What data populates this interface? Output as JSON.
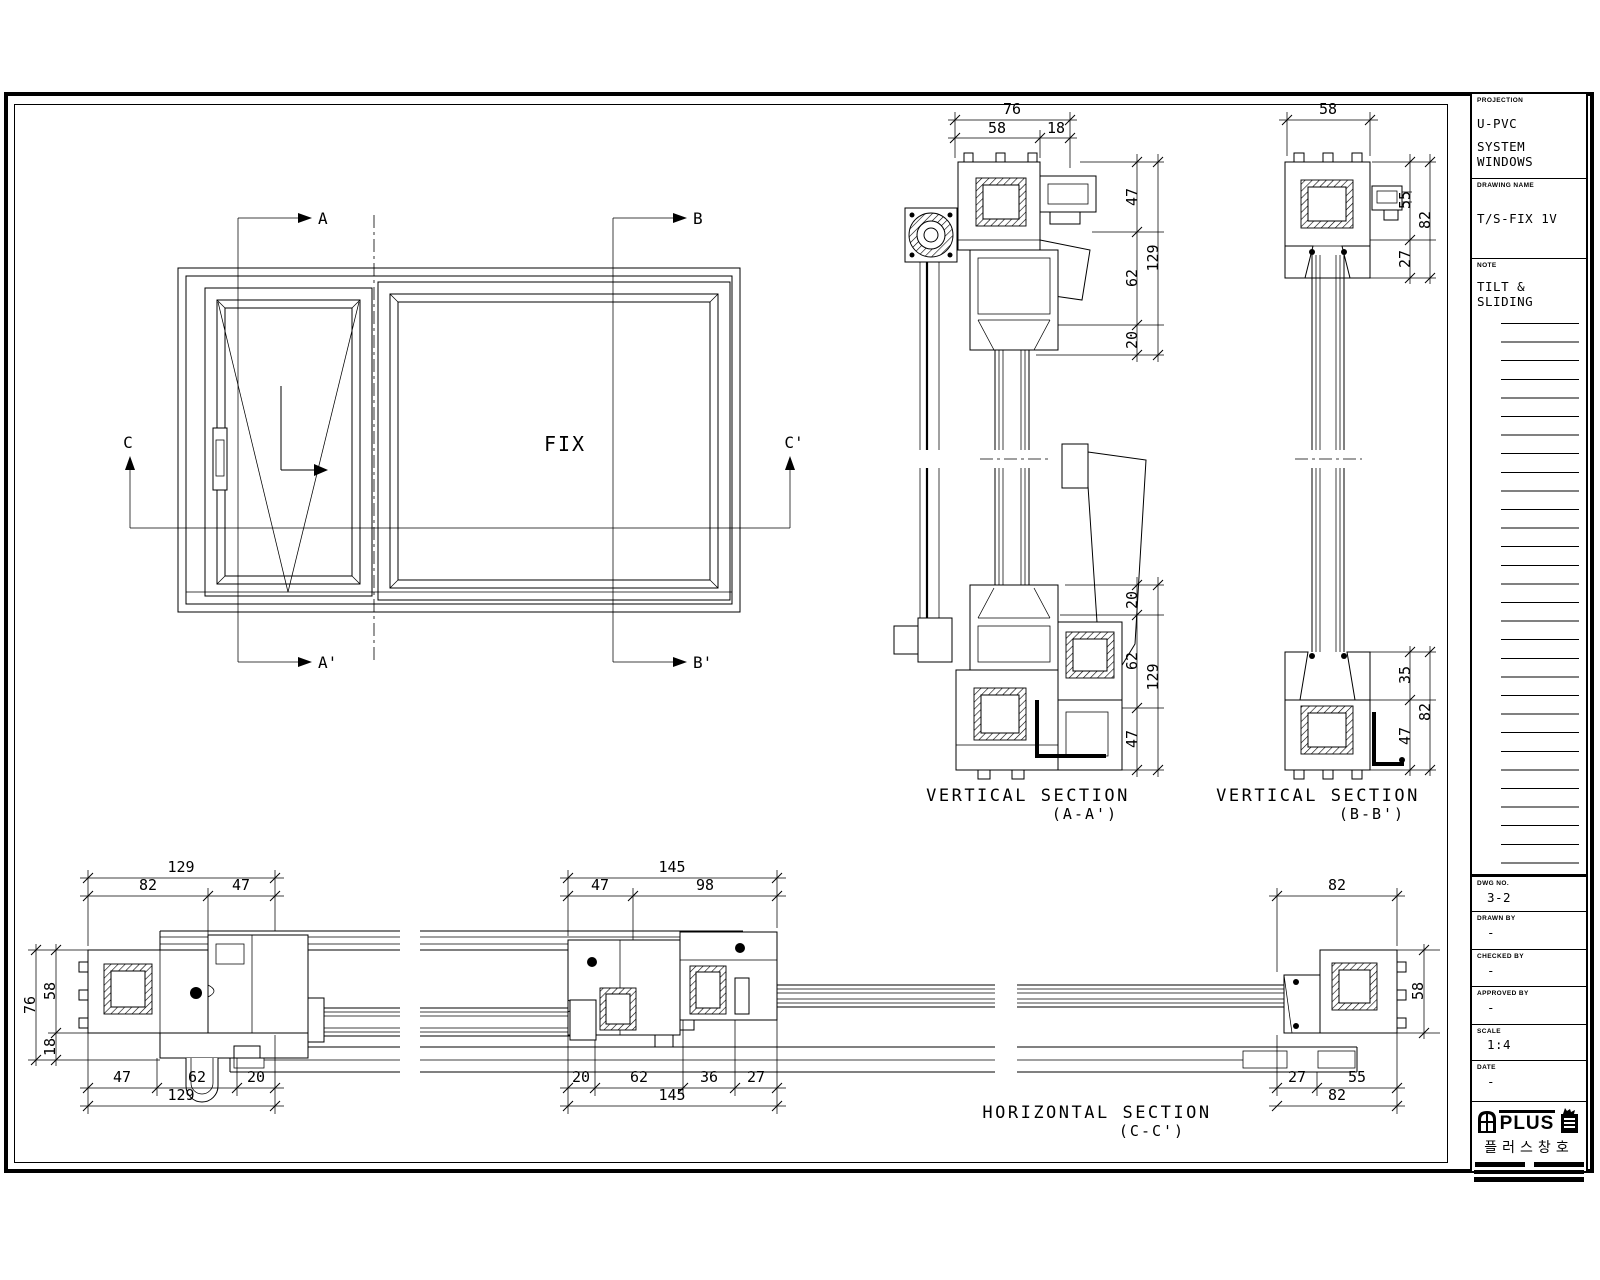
{
  "elevation": {
    "fix_label": "FIX",
    "marker_a": "A",
    "marker_a_prime": "A'",
    "marker_b": "B",
    "marker_b_prime": "B'",
    "marker_c": "C",
    "marker_c_prime": "C'"
  },
  "sections": {
    "aa": {
      "title": "VERTICAL SECTION",
      "subtitle": "(A-A')",
      "top_total": "76",
      "top_a": "58",
      "top_b": "18",
      "rt_a": "47",
      "rt_b": "62",
      "rt_c": "20",
      "rt_total": "129",
      "rb_a": "20",
      "rb_b": "62",
      "rb_c": "47",
      "rb_total": "129"
    },
    "bb": {
      "title": "VERTICAL SECTION",
      "subtitle": "(B-B')",
      "top_total": "58",
      "rt_a": "55",
      "rt_b": "27",
      "rt_total": "82",
      "rb_a": "35",
      "rb_b": "47",
      "rb_total": "82"
    },
    "cc": {
      "title": "HORIZONTAL SECTION",
      "subtitle": "(C-C')",
      "l_top_total": "129",
      "l_top_a": "82",
      "l_top_b": "47",
      "l_side_total": "76",
      "l_side_a": "58",
      "l_side_b": "18",
      "l_bot_a": "47",
      "l_bot_b": "62",
      "l_bot_c": "20",
      "l_bot_total": "129",
      "m_top_total": "145",
      "m_top_a": "47",
      "m_top_b": "98",
      "m_bot_a": "20",
      "m_bot_b": "62",
      "m_bot_c": "36",
      "m_bot_d": "27",
      "m_bot_total": "145",
      "r_top_total": "82",
      "r_side": "58",
      "r_bot_a": "27",
      "r_bot_b": "55",
      "r_bot_total": "82"
    }
  },
  "title_block": {
    "projection_label": "PROJECTION",
    "projection_line1": "U-PVC",
    "projection_line2": "SYSTEM WINDOWS",
    "drawing_name_label": "DRAWING NAME",
    "drawing_name": "T/S-FIX 1V",
    "note_label": "NOTE",
    "note": "TILT & SLIDING",
    "dwg_no_label": "DWG NO.",
    "dwg_no": "3-2",
    "drawn_by_label": "DRAWN BY",
    "drawn_by": "-",
    "checked_by_label": "CHECKED BY",
    "checked_by": "-",
    "approved_by_label": "APPROVED BY",
    "approved_by": "-",
    "scale_label": "SCALE",
    "scale": "1:4",
    "date_label": "DATE",
    "date": "-",
    "logo_text": "PLUS",
    "logo_korean": "플러스창호"
  }
}
